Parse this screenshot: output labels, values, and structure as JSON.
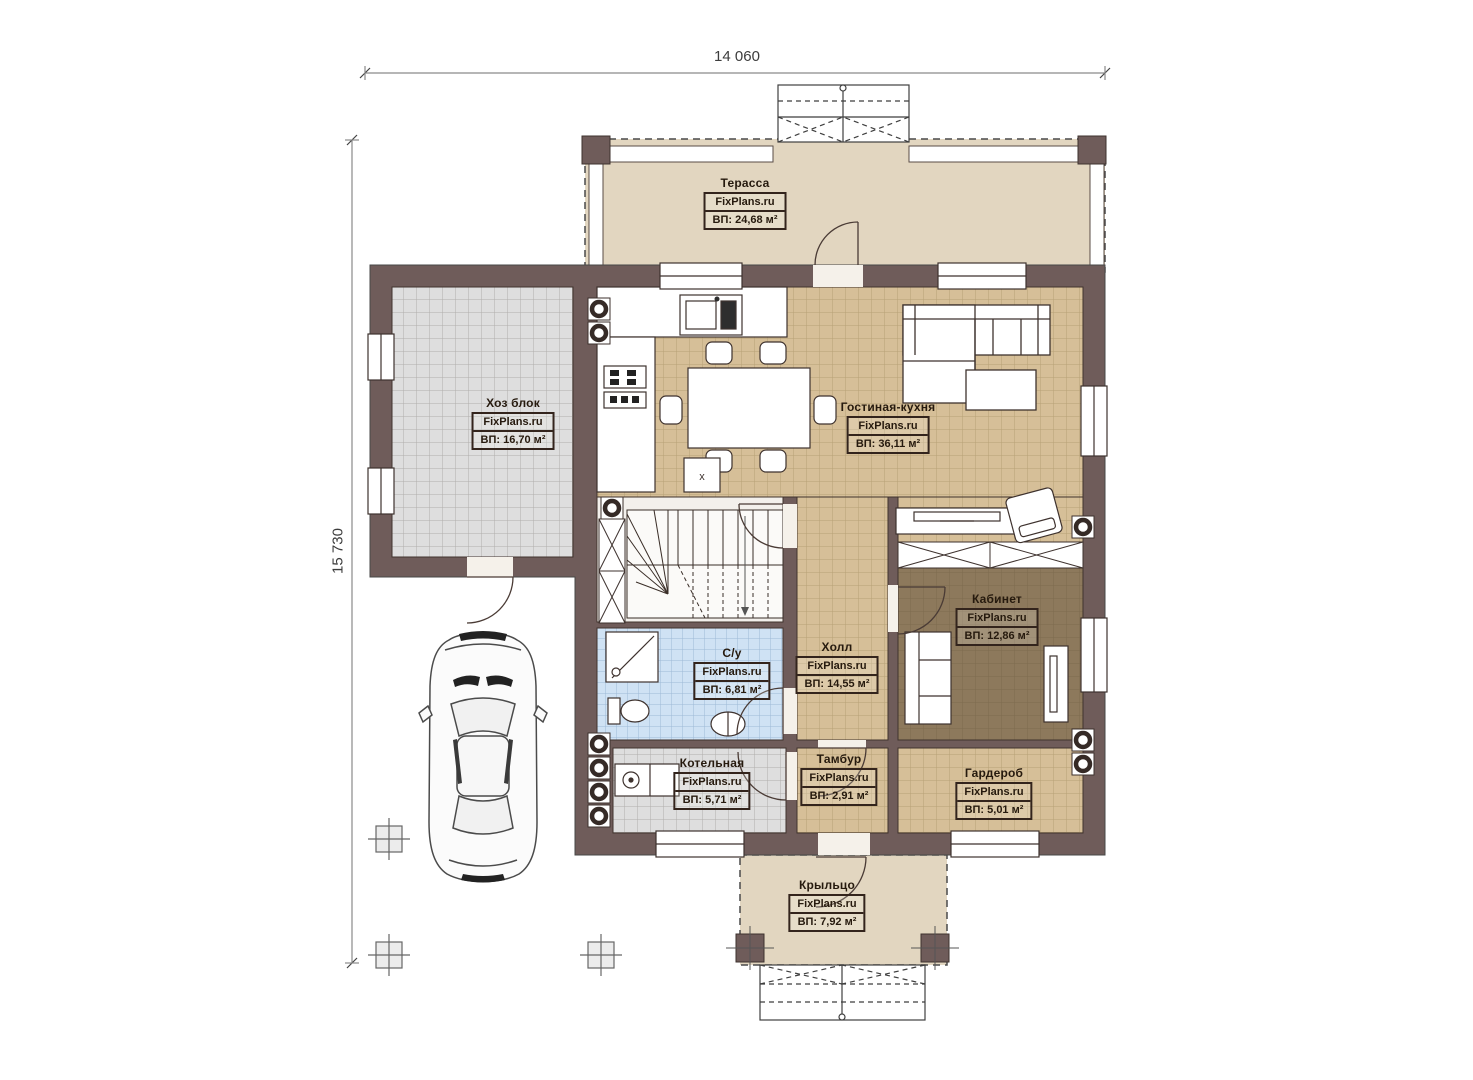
{
  "dimensions": {
    "width": "14 060",
    "height": "15 730"
  },
  "rooms": {
    "terrace": {
      "name": "Терасса",
      "watermark": "FixPlans.ru",
      "area": "ВП: 24,68 м²"
    },
    "utility": {
      "name": "Хоз блок",
      "watermark": "FixPlans.ru",
      "area": "ВП: 16,70 м²"
    },
    "living_kitchen": {
      "name": "Гостиная-кухня",
      "watermark": "FixPlans.ru",
      "area": "ВП: 36,11 м²"
    },
    "office": {
      "name": "Кабинет",
      "watermark": "FixPlans.ru",
      "area": "ВП: 12,86 м²"
    },
    "bathroom": {
      "name": "С/у",
      "watermark": "FixPlans.ru",
      "area": "ВП: 6,81 м²"
    },
    "hall": {
      "name": "Холл",
      "watermark": "FixPlans.ru",
      "area": "ВП: 14,55 м²"
    },
    "boiler": {
      "name": "Котельная",
      "watermark": "FixPlans.ru",
      "area": "ВП: 5,71 м²"
    },
    "vestibule": {
      "name": "Тамбур",
      "watermark": "FixPlans.ru",
      "area": "ВП: 2,91 м²"
    },
    "wardrobe": {
      "name": "Гардероб",
      "watermark": "FixPlans.ru",
      "area": "ВП: 5,01 м²"
    },
    "porch": {
      "name": "Крыльцо",
      "watermark": "FixPlans.ru",
      "area": "ВП: 7,92 м²"
    }
  },
  "misc": {
    "kitchen_vent_label": "x"
  },
  "colors": {
    "wall": "#6f5c5a",
    "terrace_floor": "#e2d6c0",
    "tile_tan": "#d6bf98",
    "tile_gray": "#dedede",
    "tile_blue": "#cfe2f4",
    "office_floor": "#8d795c"
  }
}
